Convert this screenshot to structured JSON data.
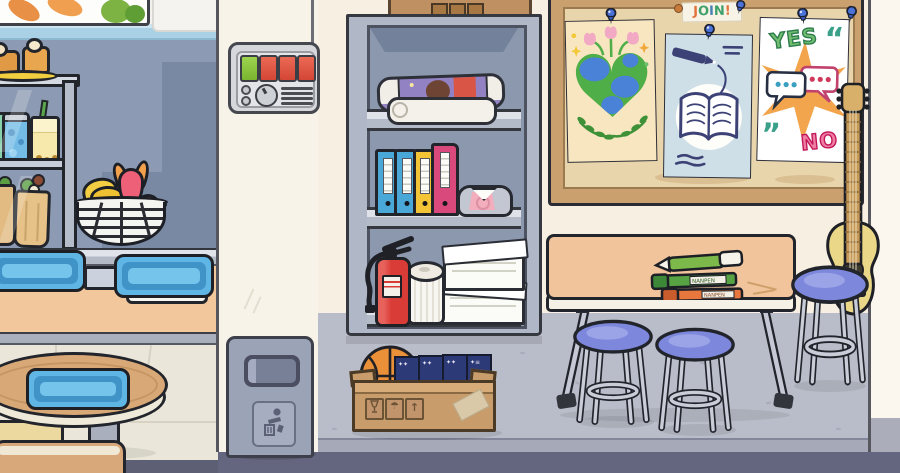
{
  "scene": {
    "game_style": "toca-life-school",
    "rooms": [
      "cafeteria",
      "hallway",
      "classroom"
    ]
  },
  "palette": {
    "cafeteria_wall": "#8c9bb3",
    "cafeteria_wall_shadow": "#7989a4",
    "stripe_blue": "#a9d0e4",
    "cream_wall": "#f8f3e8",
    "classroom_wall": "#f7efe1",
    "floor_gray": "#b9bdc9",
    "floor_step": "#a7abb9",
    "baseboard": "#63667e",
    "cafeteria_floor": "#eae6da",
    "counter_peach": "#f2c79c",
    "cabinet_gray": "#b0b8c8",
    "cabinet_back": "#8b98ae",
    "tray_blue": "#5fb6e4",
    "stool_seat": "#7d88dd",
    "table_top": "#f1c49c",
    "board_frame": "#c9a06e",
    "board_face": "#e9d5ac",
    "guitar_body": "#ead888",
    "basketball": "#e99038",
    "extinguisher_red": "#d93b36",
    "binder_colors": [
      "#49a8d8",
      "#49a8d8",
      "#f2c436",
      "#d9497b"
    ],
    "button_green": "#8cc63f",
    "button_red": "#e2574a",
    "pushpin_blue": "#4a72d8"
  },
  "cafeteria": {
    "wall_picture": "vegetables artwork",
    "case_items": [
      "muffins on yellow plate",
      "blue soda can",
      "bubble tea",
      "green jar",
      "two wraps"
    ],
    "fruit_basket": [
      "bananas",
      "dragonfruit",
      "apple"
    ],
    "tray_count": 3
  },
  "hallway": {
    "control_panel": {
      "button_colors": [
        "green",
        "red",
        "red",
        "red"
      ],
      "knob": 1,
      "vent_lines": 4
    },
    "trash_can": {
      "icon": "person-throwing-litter"
    },
    "cabinet": {
      "top": "cardboard box",
      "shelf1": [
        "rolled poster",
        "rolled white mat"
      ],
      "shelf2": [
        "blue binder",
        "blue binder",
        "yellow binder",
        "pink binder",
        "folded shirt"
      ],
      "shelf3": [
        "fire extinguisher",
        "paper towel roll",
        "two paper stacks"
      ]
    },
    "floor_box": {
      "contents": [
        "basketball",
        "navy books"
      ],
      "symbols": [
        "fragile-glass",
        "umbrella",
        "this-side-up"
      ]
    }
  },
  "classroom": {
    "join_sign": {
      "text": "JOIN!",
      "letters": [
        {
          "ch": "J",
          "color": "#e2733c"
        },
        {
          "ch": "O",
          "color": "#3fa06b"
        },
        {
          "ch": "I",
          "color": "#4a7fb5"
        },
        {
          "ch": "N",
          "color": "#3fa06b"
        },
        {
          "ch": "!",
          "color": "#e2733c"
        }
      ]
    },
    "posters": [
      {
        "name": "earth-heart-poster",
        "motifs": [
          "heart-shaped earth",
          "pink tulips",
          "laurel leaves",
          "stars"
        ]
      },
      {
        "name": "open-book-poster",
        "motifs": [
          "pen",
          "open book",
          "scribbles"
        ]
      },
      {
        "name": "yes-no-poster",
        "yes": "YES",
        "no": "NO",
        "quote_open": "“",
        "quote_close": "„",
        "motifs": [
          "speech bubbles",
          "orange starburst"
        ]
      }
    ],
    "markers": [
      {
        "type": "green-pen"
      },
      {
        "type": "green-marker",
        "label": "NANPEN"
      },
      {
        "type": "orange-marker",
        "label": "NANPEN"
      }
    ],
    "stool_count": 3,
    "furniture": [
      "work table",
      "acoustic guitar"
    ]
  }
}
